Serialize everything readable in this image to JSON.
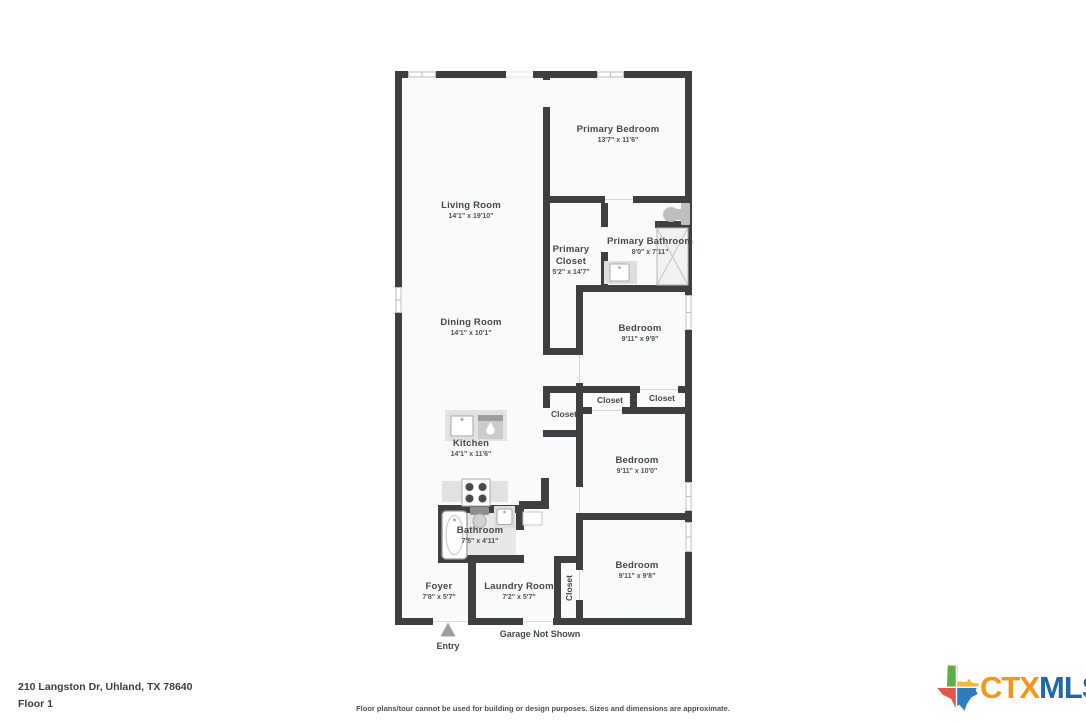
{
  "plan": {
    "rooms": [
      {
        "id": "living_room",
        "name": "Living Room",
        "dims": "14'1\" x 19'10\""
      },
      {
        "id": "primary_bedroom",
        "name": "Primary Bedroom",
        "dims": "13'7\" x 11'6\""
      },
      {
        "id": "primary_closet",
        "name": "Primary Closet",
        "dims": "5'2\" x 14'7\""
      },
      {
        "id": "primary_bathroom",
        "name": "Primary Bathroom",
        "dims": "8'0\" x 7'11\""
      },
      {
        "id": "dining_room",
        "name": "Dining Room",
        "dims": "14'1\" x 10'1\""
      },
      {
        "id": "bedroom_1",
        "name": "Bedroom",
        "dims": "9'11\" x 9'9\""
      },
      {
        "id": "kitchen",
        "name": "Kitchen",
        "dims": "14'1\" x 11'6\""
      },
      {
        "id": "bedroom_2",
        "name": "Bedroom",
        "dims": "9'11\" x 10'0\""
      },
      {
        "id": "bathroom",
        "name": "Bathroom",
        "dims": "7'5\" x 4'11\""
      },
      {
        "id": "bedroom_3",
        "name": "Bedroom",
        "dims": "9'11\" x 9'8\""
      },
      {
        "id": "foyer",
        "name": "Foyer",
        "dims": "7'8\" x 5'7\""
      },
      {
        "id": "laundry_room",
        "name": "Laundry Room",
        "dims": "7'2\" x 5'7\""
      }
    ],
    "closets": [
      "Closet",
      "Closet",
      "Closet",
      "Closet"
    ],
    "garage_note": "Garage Not Shown",
    "entry_label": "Entry",
    "icons": {
      "entry-arrow-icon": "triangle-up",
      "toilet-icon": "toilet",
      "shower-icon": "shower-with-x",
      "bathtub-icon": "bathtub",
      "sink-icon": "sink-vanity",
      "stove-icon": "four-burner-cooktop",
      "dishwasher-icon": "dishwasher-droplet",
      "kitchen-sink-icon": "kitchen-sink",
      "window-icon": "window-frame"
    }
  },
  "footer": {
    "address": "210 Langston Dr, Uhland, TX 78640",
    "floor_label": "Floor 1",
    "disclaimer": "Floor plans/tour cannot be used for building or design purposes. Sizes and dimensions are approximate."
  },
  "logo": {
    "ctx": "CTX",
    "mls": "MLS"
  },
  "colors": {
    "wall": "#3d3f41",
    "room_fill": "#fafafa",
    "bath_floor": "#e8e8e8",
    "counter": "#e2e2e2",
    "logo_orange": "#F7941E",
    "logo_blue": "#2167AE",
    "logo_green": "#5CAE46",
    "logo_yellow": "#F9B232",
    "logo_red": "#E2574C"
  }
}
